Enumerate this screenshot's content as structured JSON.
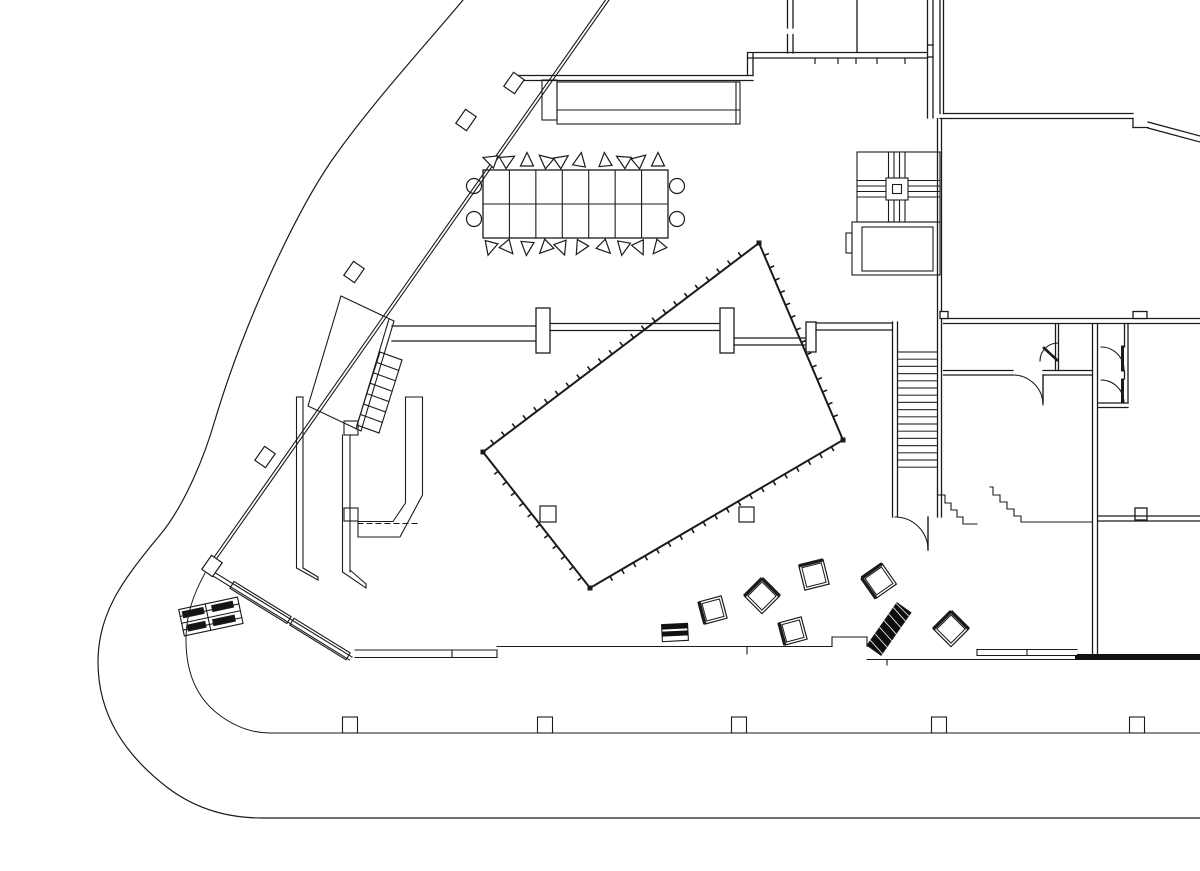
{
  "meta": {
    "description": "architectural ground-floor plan, black ink on white, no text labels visible",
    "ink_color": "#1b1b1b",
    "background_color": "#ffffff",
    "tread_color": "#3a3a3a"
  },
  "void_quad": {
    "points": [
      [
        759,
        243
      ],
      [
        843,
        440
      ],
      [
        590,
        588
      ],
      [
        483,
        452
      ]
    ],
    "tick_spacing": 13.5,
    "tick_len": 5,
    "inner_columns": [
      [
        540,
        506,
        16,
        16
      ],
      [
        739,
        507,
        15,
        15
      ]
    ]
  },
  "stair_treads": {
    "x1": 898,
    "x2": 937,
    "y_start": 352,
    "count": 17,
    "spacing": 7.2
  },
  "conference_table": {
    "x": 483,
    "y": 170,
    "w": 185,
    "h": 68,
    "cols": 7,
    "chair_xs": [
      490,
      508,
      527,
      545,
      562,
      580,
      605,
      623,
      640,
      658
    ],
    "chair_rot_top": [
      -70,
      60,
      0,
      -50,
      55,
      10,
      -5,
      -60,
      50,
      0
    ],
    "chair_rot_bottom": [
      195,
      140,
      185,
      225,
      160,
      210,
      135,
      190,
      155,
      220
    ],
    "top_y": 160,
    "bottom_y": 248,
    "end_circles": [
      [
        474,
        186
      ],
      [
        474,
        219
      ],
      [
        677,
        186
      ],
      [
        677,
        219
      ]
    ],
    "circle_r": 7.5
  },
  "pavement_columns": {
    "y": 717,
    "w": 15,
    "h": 16,
    "centers": [
      350,
      545,
      739,
      939,
      1137
    ]
  },
  "window_ticks": {
    "y1": 58,
    "y2": 64,
    "xs": [
      815,
      838,
      856,
      877,
      905
    ]
  },
  "glazing_blocks": {
    "rot": -55,
    "w": 17,
    "h": 13,
    "centers": [
      [
        466,
        120
      ],
      [
        354,
        272
      ],
      [
        265,
        457
      ],
      [
        514,
        83
      ],
      [
        212,
        566
      ]
    ]
  },
  "stools": [
    {
      "cx": 713,
      "cy": 610,
      "s": 23,
      "rot": -15,
      "edges": [
        "left"
      ]
    },
    {
      "cx": 762,
      "cy": 596,
      "s": 25,
      "rot": 45,
      "edges": [
        "top",
        "left"
      ]
    },
    {
      "cx": 814,
      "cy": 575,
      "s": 25,
      "rot": -14,
      "edges": [
        "top"
      ]
    },
    {
      "cx": 879,
      "cy": 581,
      "s": 25,
      "rot": -35,
      "edges": [
        "top",
        "left"
      ]
    },
    {
      "cx": 793,
      "cy": 631,
      "s": 23,
      "rot": -15,
      "edges": [
        "left"
      ]
    },
    {
      "cx": 951,
      "cy": 629,
      "s": 25,
      "rot": 45,
      "edges": [
        "top",
        "left"
      ]
    }
  ],
  "hatched_bar": {
    "cx": 889,
    "cy": 629,
    "len": 52,
    "wid": 17,
    "rot": -55
  },
  "striped_box": {
    "cx": 675,
    "cy": 633,
    "w": 26,
    "h": 17,
    "rot": -3
  }
}
